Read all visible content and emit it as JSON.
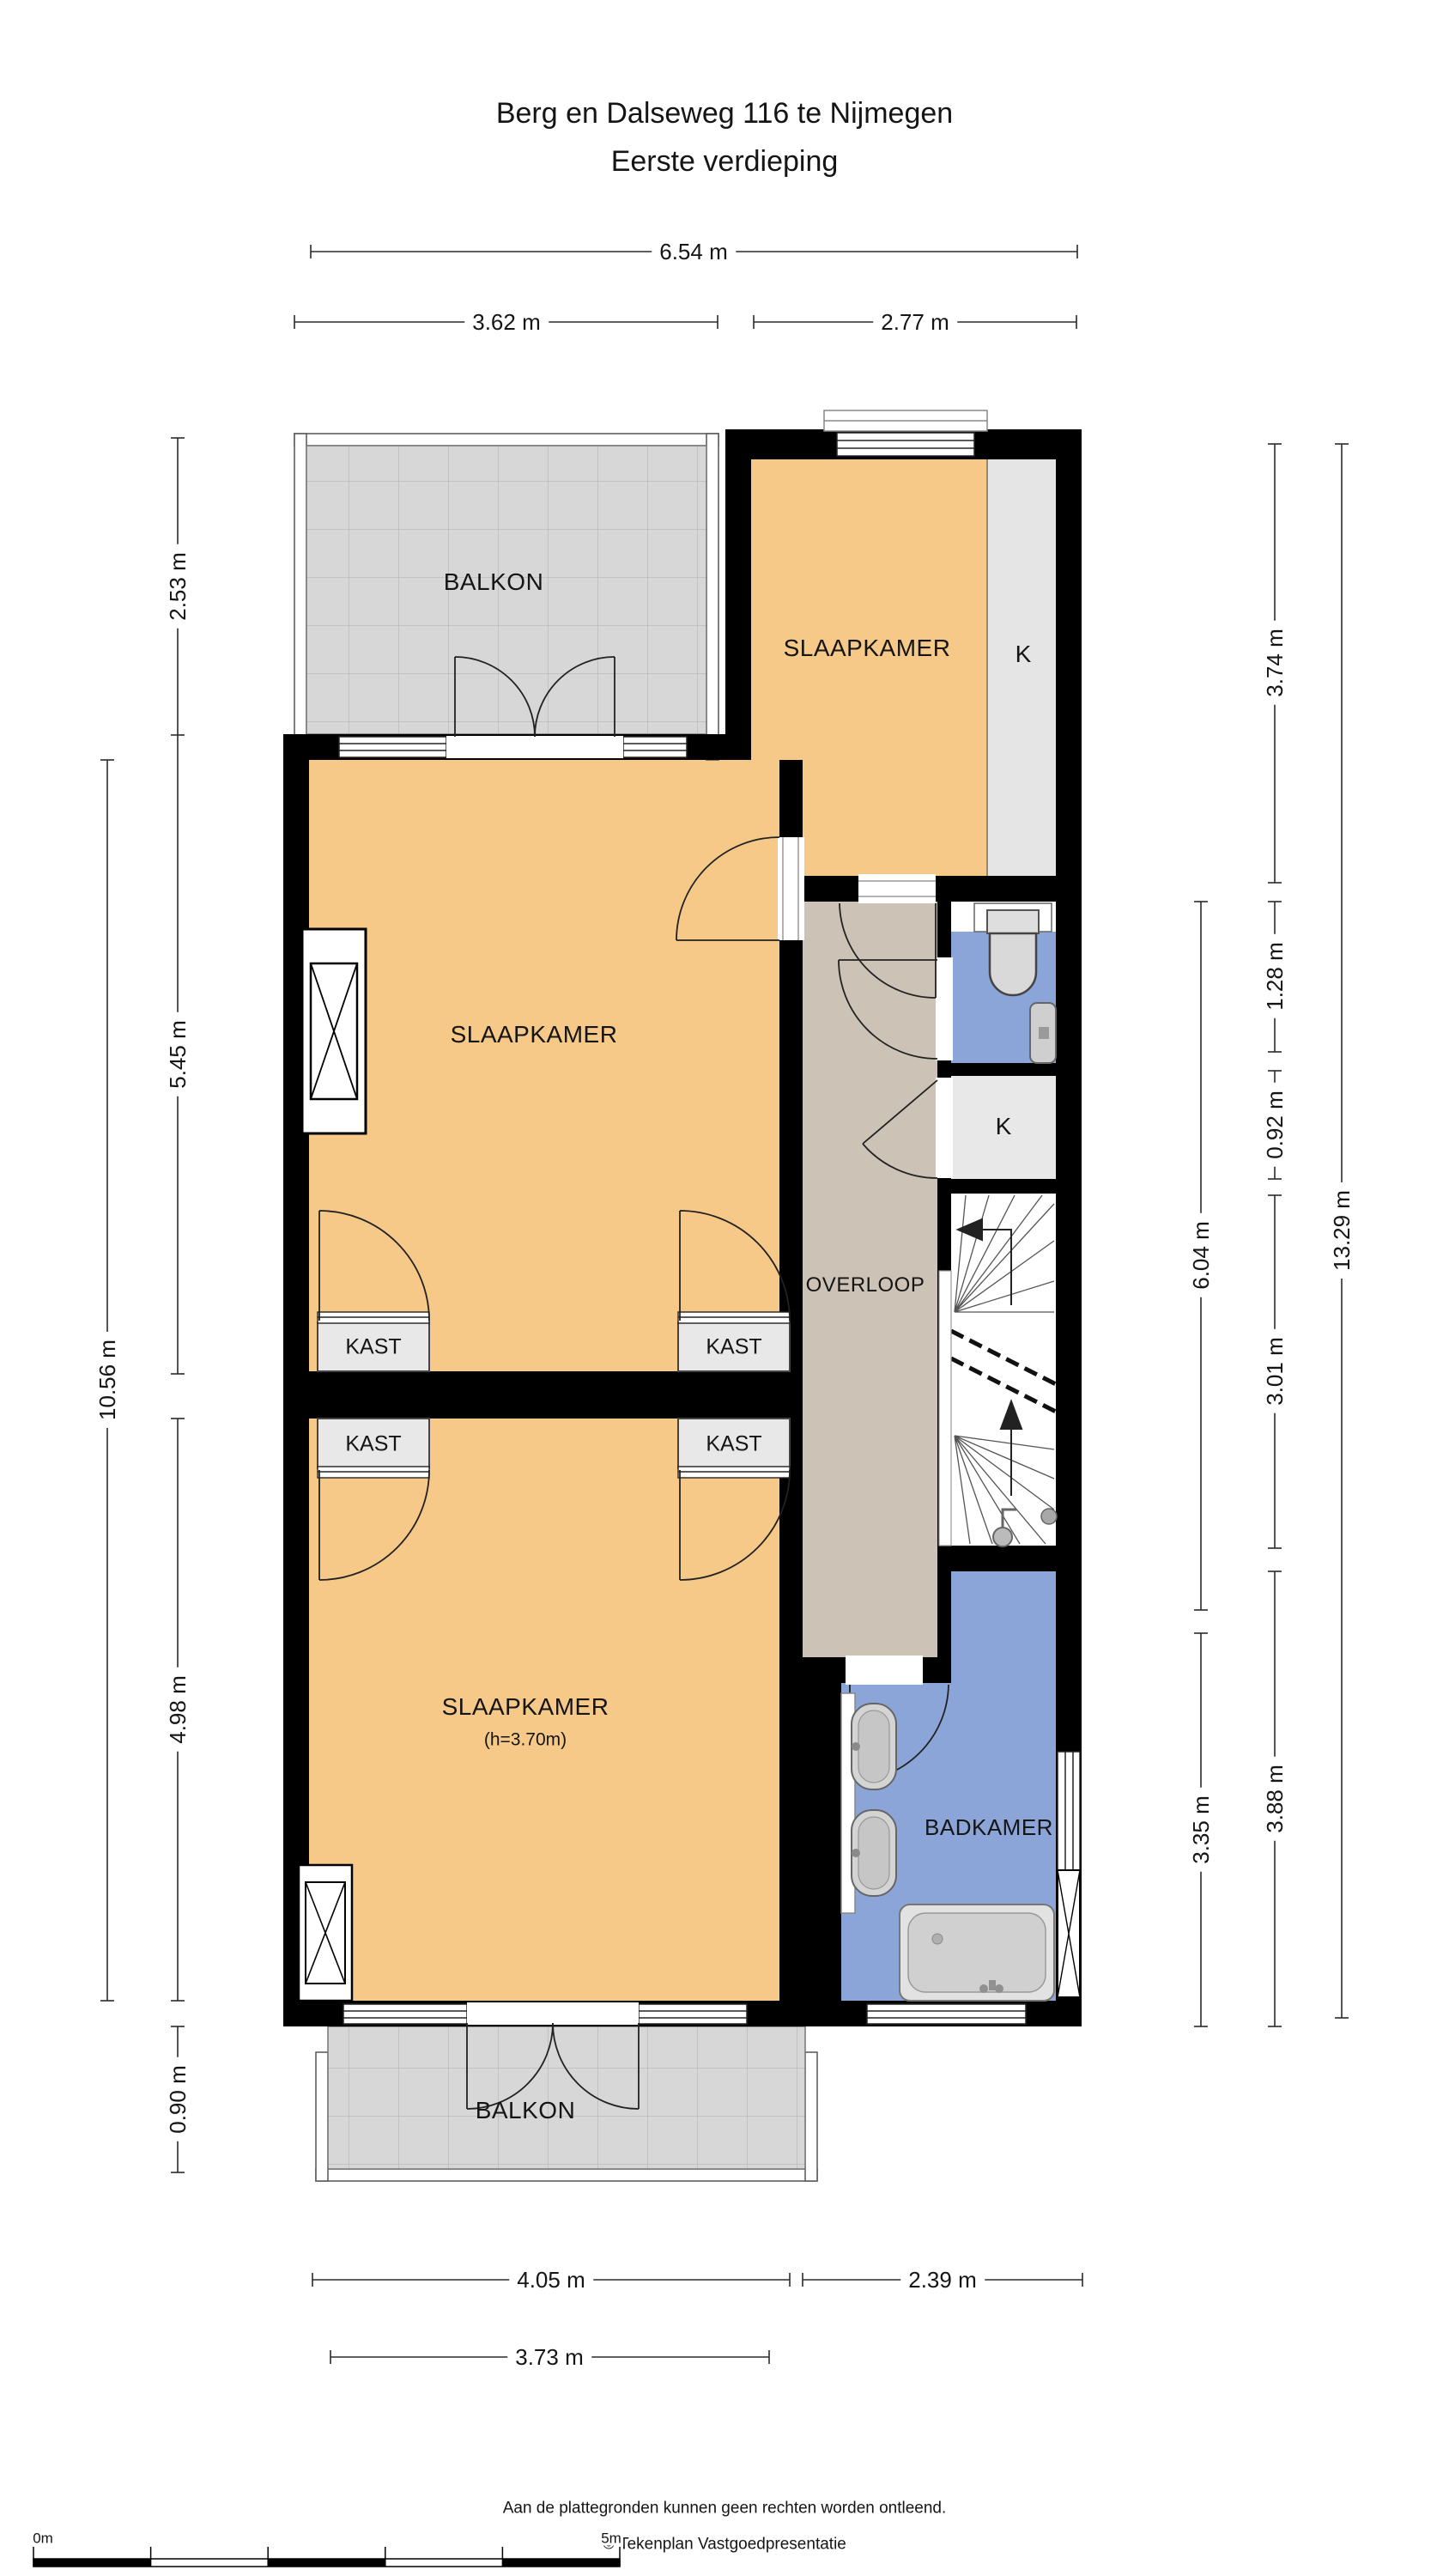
{
  "title": {
    "line1": "Berg en Dalseweg 116 te Nijmegen",
    "line2": "Eerste verdieping"
  },
  "rooms": {
    "balkon_top": "BALKON",
    "slaapkamer_top": "SLAAPKAMER",
    "k_top": "K",
    "slaapkamer_mid": "SLAAPKAMER",
    "overloop": "OVERLOOP",
    "kast_1": "KAST",
    "kast_2": "KAST",
    "kast_3": "KAST",
    "kast_4": "KAST",
    "k_closet": "K",
    "slaapkamer_bottom": "SLAAPKAMER",
    "slaapkamer_bottom_sub": "(h=3.70m)",
    "badkamer": "BADKAMER",
    "balkon_bottom": "BALKON"
  },
  "dims": {
    "h654": "6.54 m",
    "h362": "3.62 m",
    "h277": "2.77 m",
    "v253": "2.53 m",
    "v545": "5.45 m",
    "v498": "4.98 m",
    "v090": "0.90 m",
    "v1056": "10.56 m",
    "v374": "3.74 m",
    "v128": "1.28 m",
    "v092": "0.92 m",
    "v301": "3.01 m",
    "v604": "6.04 m",
    "v335": "3.35 m",
    "v388": "3.88 m",
    "v1329": "13.29 m",
    "h405": "4.05 m",
    "h239": "2.39 m",
    "h373": "3.73 m"
  },
  "footer": {
    "disclaimer": "Aan de plattegronden kunnen geen rechten worden ontleend.",
    "copyright": "© Tekenplan Vastgoedpresentatie"
  },
  "scale_bar": {
    "start_label": "0m",
    "end_label": "5m"
  },
  "colors": {
    "wall": "#000000",
    "room_orange": "#f6c988",
    "hall_taupe": "#ccc2b5",
    "bath_blue": "#8ca5d8",
    "closet_gray": "#e8e8e8",
    "balcony_gray": "#d7d7d7",
    "fixture_gray": "#d2d2d2",
    "dim_line": "#2a2a2a"
  }
}
